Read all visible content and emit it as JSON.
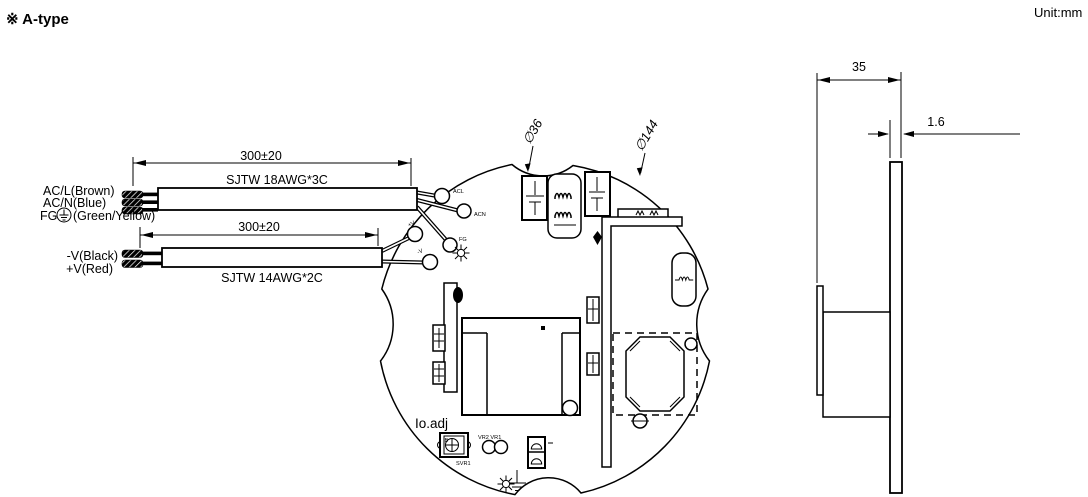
{
  "header": {
    "type_label": "※ A-type",
    "unit_label": "Unit:mm"
  },
  "input_cable": {
    "length_dim": "300±20",
    "spec": "SJTW 18AWG*3C",
    "wire_acl": "AC/L(Brown)",
    "wire_acn": "AC/N(Blue)",
    "wire_fg_prefix": "FG",
    "wire_fg_suffix": "(Green/Yellow)"
  },
  "output_cable": {
    "length_dim": "300±20",
    "spec": "SJTW 14AWG*2C",
    "wire_neg": "-V(Black)",
    "wire_pos": "+V(Red)"
  },
  "board": {
    "dia_inner": "∅36",
    "dia_outer": "∅144",
    "terminals": {
      "acl": "ACL",
      "acn": "ACN",
      "fg": "FG",
      "pos": "+V",
      "neg": "-V"
    },
    "adjust_label": "Io.adj",
    "pot_ref": "SVR1",
    "pot_letter": "B",
    "vr_labels": "VR2  VR1"
  },
  "side_view": {
    "depth_dim": "35",
    "thickness_dim": "1.6"
  },
  "colors": {
    "line": "#000000",
    "background": "#ffffff"
  }
}
